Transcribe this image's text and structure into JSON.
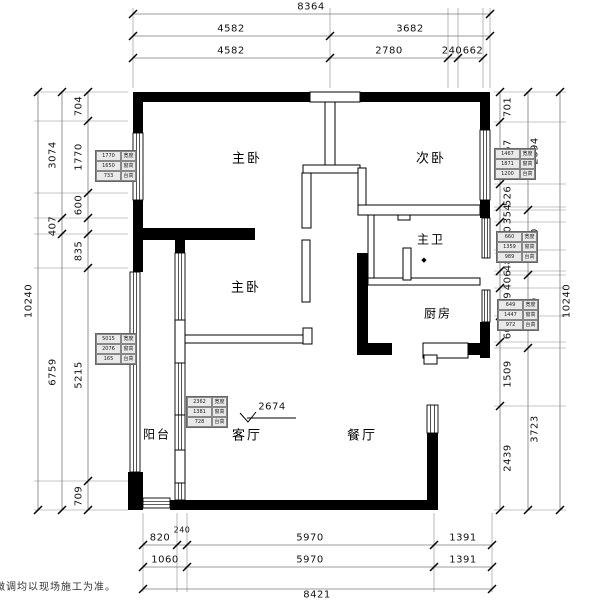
{
  "footer_note": "微调均以现场施工为准。",
  "rooms": {
    "master_bedroom_top": "主卧",
    "second_bedroom": "次卧",
    "master_bathroom": "主卫",
    "kitchen": "厨房",
    "master_bedroom_mid": "主卧",
    "balcony": "阳台",
    "living_room": "客厅",
    "dining_room": "餐厅"
  },
  "symbols": {
    "floor_drain": "◆"
  },
  "dimensions": {
    "top": {
      "row1": [
        "8364"
      ],
      "row2": [
        "4582",
        "3682"
      ],
      "row3": [
        "4582",
        "2780",
        "240",
        "662"
      ]
    },
    "bottom": {
      "row1": [
        "820",
        "240",
        "5970",
        "1391"
      ],
      "row2": [
        "1060",
        "5970",
        "1391"
      ],
      "row3": [
        "8421"
      ]
    },
    "left": {
      "inner": [
        "704",
        "1770",
        "600",
        "835",
        "5215",
        "709"
      ],
      "middle": [
        "3074",
        "407",
        "6759"
      ],
      "outer": [
        "10240"
      ]
    },
    "right": {
      "inner": [
        "701",
        "1467",
        "526",
        "354",
        "660",
        "486",
        "406",
        "649",
        "604",
        "1509",
        "2439"
      ],
      "middle": [
        "2694",
        "1500",
        "1659",
        "3723"
      ],
      "outer": [
        "10240"
      ]
    },
    "interior": {
      "living_room_width": "2674"
    }
  },
  "window_tags": {
    "left_upper": [
      [
        "1770",
        "宽度"
      ],
      [
        "1650",
        "窗高"
      ],
      [
        "733",
        "台高"
      ]
    ],
    "left_lower": [
      [
        "5015",
        "宽度"
      ],
      [
        "2076",
        "窗高"
      ],
      [
        "165",
        "台高"
      ]
    ],
    "right_upper": [
      [
        "1467",
        "宽度"
      ],
      [
        "1871",
        "窗高"
      ],
      [
        "1200",
        "台高"
      ]
    ],
    "right_middle": [
      [
        "660",
        "宽度"
      ],
      [
        "1359",
        "窗高"
      ],
      [
        "989",
        "台高"
      ]
    ],
    "right_lower": [
      [
        "649",
        "宽度"
      ],
      [
        "1447",
        "窗高"
      ],
      [
        "972",
        "台高"
      ]
    ],
    "living": [
      [
        "2362",
        "宽度"
      ],
      [
        "1381",
        "窗高"
      ],
      [
        "728",
        "台高"
      ]
    ]
  }
}
